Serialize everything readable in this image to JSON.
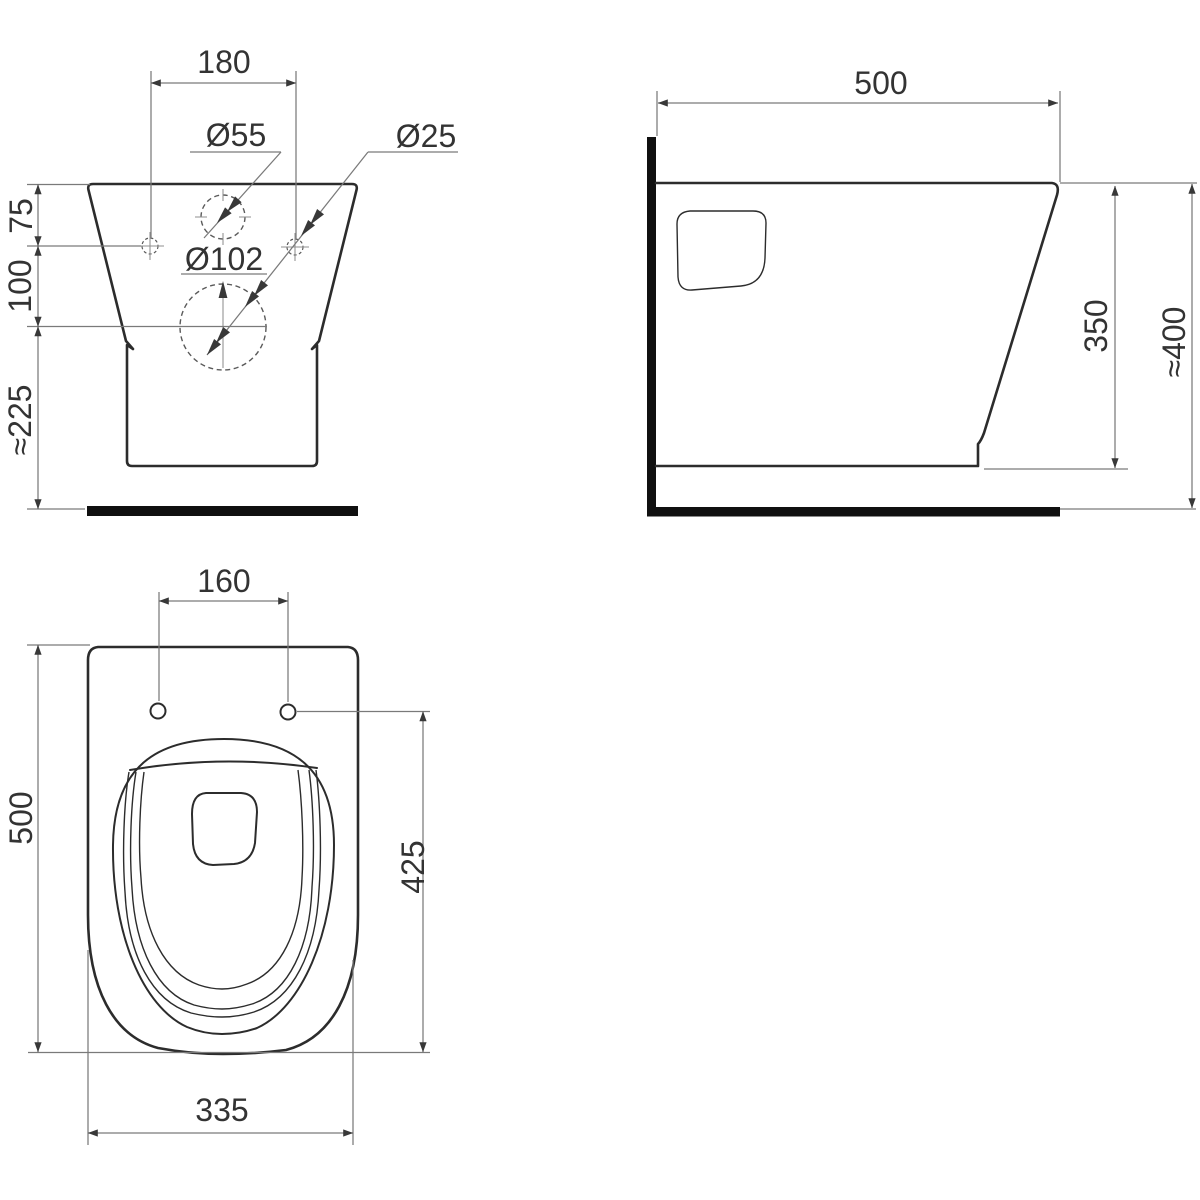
{
  "colors": {
    "bg": "#ffffff",
    "outline": "#2c2c2c",
    "thin": "#7a7a7a",
    "dash": "#5a5a5a",
    "cross": "#8f8f8f",
    "black": "#101010",
    "arrow": "#383838",
    "text": "#333333"
  },
  "views": {
    "rear": {
      "dims": {
        "hole_spacing": "180",
        "flush_hole_diameter": "Ø55",
        "fixing_hole_diameter": "Ø25",
        "outlet_diameter": "Ø102",
        "top_to_fixing_holes": "75",
        "fixing_holes_to_outlet": "100",
        "outlet_to_floor": "≈225"
      }
    },
    "side": {
      "dims": {
        "depth": "500",
        "rim_height": "350",
        "overall_height": "≈400"
      }
    },
    "top": {
      "dims": {
        "seat_hole_spacing": "160",
        "overall_length": "500",
        "holes_to_front": "425",
        "overall_width": "335"
      }
    }
  }
}
